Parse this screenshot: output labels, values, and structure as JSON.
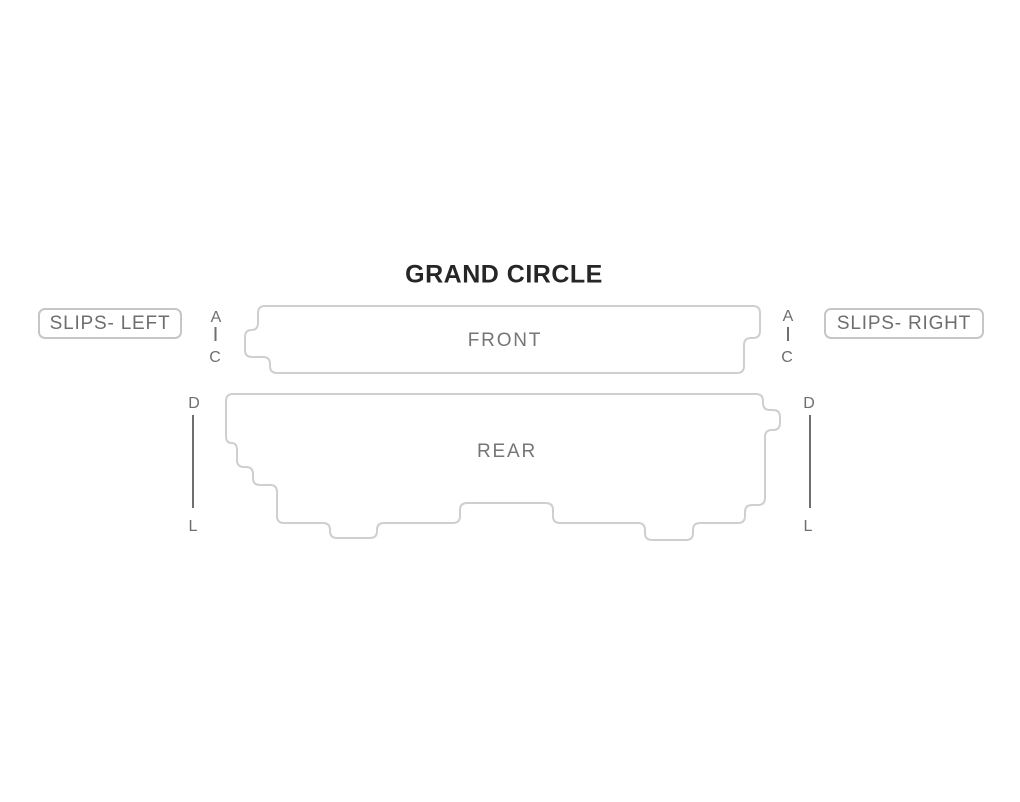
{
  "title": "GRAND CIRCLE",
  "sections": {
    "front": {
      "label": "FRONT"
    },
    "rear": {
      "label": "REAR"
    },
    "slips_left": {
      "label": "SLIPS- LEFT"
    },
    "slips_right": {
      "label": "SLIPS- RIGHT"
    }
  },
  "row_ranges": {
    "front_left": {
      "from": "A",
      "to": "C"
    },
    "front_right": {
      "from": "A",
      "to": "C"
    },
    "rear_left": {
      "from": "D",
      "to": "L"
    },
    "rear_right": {
      "from": "D",
      "to": "L"
    }
  },
  "colors": {
    "background": "#ffffff",
    "section_outline": "#cfcfcf",
    "section_label_text": "#757575",
    "row_letter_text": "#6e6e6e",
    "range_line": "#6f6f6f",
    "slips_border": "#c6c6c6",
    "title_text": "#262626"
  }
}
